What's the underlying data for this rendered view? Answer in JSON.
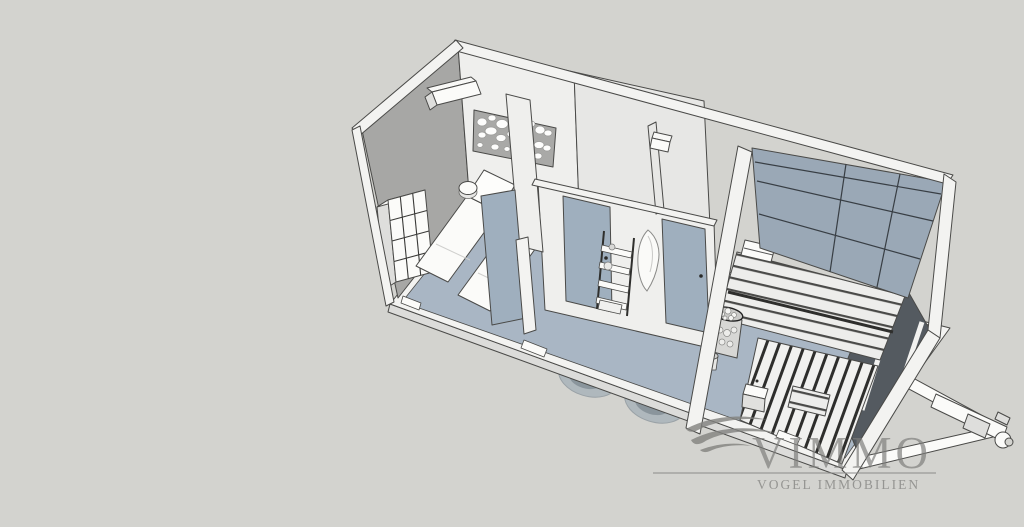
{
  "watermark": {
    "brand": "VIMMO",
    "subtitle": "VOGEL IMMOBILIEN"
  },
  "colors": {
    "background": "#d3d3cf",
    "outline": "#4a4a48",
    "floor": "#a9b6c4",
    "wall_light": "#efefed",
    "wall_gray": "#a7a7a5",
    "wall_band": "#f3f3f1",
    "door": "#9fafbe",
    "glass": "#9aa8b6",
    "glass_dark": "#545a60",
    "wheel": "#93a3b0",
    "watermark": "#7d7d7b"
  }
}
